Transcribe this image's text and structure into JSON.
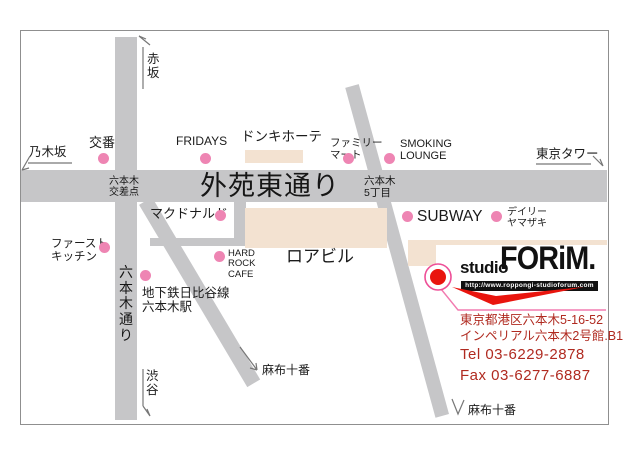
{
  "colors": {
    "road_gray": "#c6c6c8",
    "building_beige": "#f3e2d1",
    "poi_dot_pink": "#ee85b3",
    "brand_red": "#e9150e",
    "address_red": "#b02a20",
    "leader_pink": "#f27bb0"
  },
  "map": {
    "roads": {
      "gaien_higashi_label": "外苑東通り",
      "roppongi_dori_label": "六本木通り",
      "roppongi_crossing_line1": "六本木",
      "roppongi_crossing_line2": "交差点",
      "chome5_line1": "六本木",
      "chome5_line2": "5丁目"
    },
    "directions": {
      "akasaka": "赤坂",
      "nogizaka": "乃木坂",
      "tokyo_tower": "東京タワー",
      "shibuya": "渋谷",
      "azabu_juban_south": "麻布十番",
      "azabu_juban_southeast": "麻布十番"
    },
    "pois": {
      "koban": "交番",
      "fridays": "FRIDAYS",
      "don_quijote": "ドンキホーテ",
      "family_mart_line1": "ファミリー",
      "family_mart_line2": "マート",
      "smoking_lounge_line1": "SMOKING",
      "smoking_lounge_line2": "LOUNGE",
      "mcdonalds": "マクドナルド",
      "subway": "SUBWAY",
      "daily_yamazaki_line1": "デイリー",
      "daily_yamazaki_line2": "ヤマザキ",
      "roa_building": "ロアビル",
      "hard_rock_line1": "HARD",
      "hard_rock_line2": "ROCK",
      "hard_rock_line3": "CAFE",
      "first_kitchen_line1": "ファースト",
      "first_kitchen_line2": "キッチン",
      "metro_station_line1": "地下鉄日比谷線",
      "metro_station_line2": "六本木駅"
    }
  },
  "logo": {
    "name_prefix": "studio",
    "name_main": "FORiM.",
    "url": "http://www.roppongi-studioforum.com"
  },
  "contact": {
    "address_line1": "東京都港区六本木5-16-52",
    "address_line2": "インペリアル六本木2号館.B1",
    "tel": "Tel 03-6229-2878",
    "fax": "Fax 03-6277-6887"
  }
}
